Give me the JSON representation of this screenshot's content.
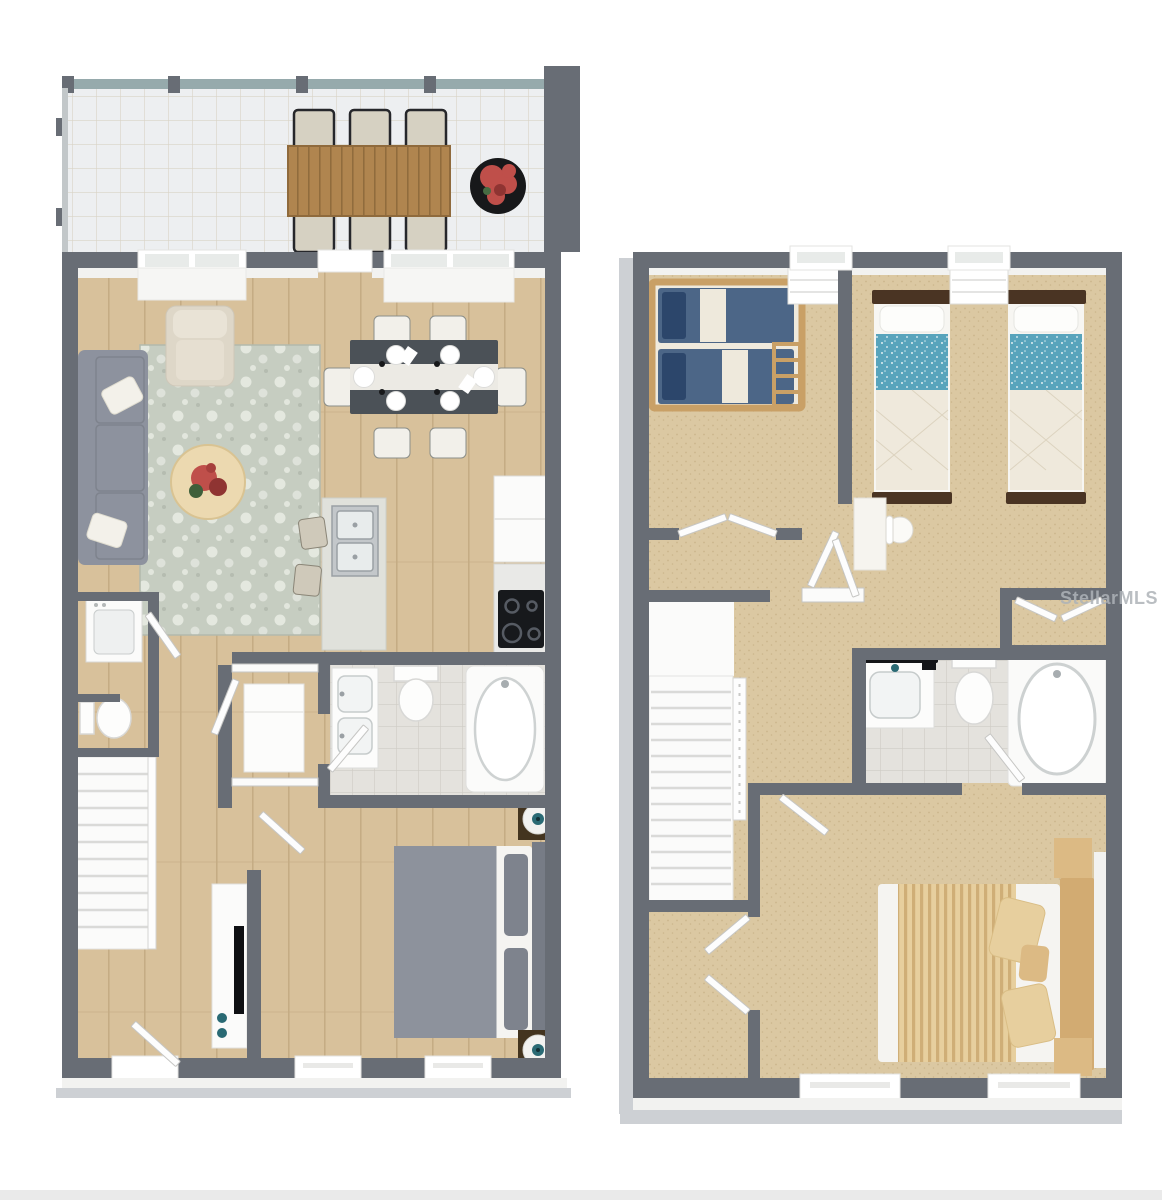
{
  "page": {
    "background": "#ffffff",
    "type": "3d-floor-plan-render",
    "bottom_bar": {
      "color": "#eaeaea",
      "border": "#d6d6d6"
    }
  },
  "watermark": {
    "text": "StellarMLS",
    "color": "#aeb3b8",
    "opacity": 0.85,
    "font_size": 18
  },
  "palette": {
    "wall": "#686d75",
    "wallFace": "#f2f2f0",
    "base3d": "#cdd0d4",
    "wood": "#d8c19b",
    "woodLine": "#c4ab83",
    "tile": "#edeff1",
    "tileLine": "#d9d3c6",
    "carpet": "#dbc8a2",
    "carpetDot": "#cbb68c",
    "bathTile": "#e4e2dd",
    "bathTileLine": "#cfccc5",
    "screen": "#96aaac",
    "rugBase": "#c6cdc1",
    "rugMotif": "#e9ece4",
    "sofa": "#8d929e",
    "sofaDark": "#7e838d",
    "pillow": "#f3f1ea",
    "armchair": "#ded7c8",
    "patioTableWood": "#b0854f",
    "patioTableLine": "#8f6a3c",
    "patioChair": "#d6d1c2",
    "chairFrame": "#26272b",
    "planter": "#17181a",
    "plant": "#bf4f4a",
    "plantDark": "#8f3432",
    "diningTable": "#4b5157",
    "runner": "#eceae4",
    "chairCream": "#f2f0ea",
    "island": "#e0e1db",
    "steel": "#c3c7ca",
    "steelDark": "#9aa0a4",
    "appliance": "#fbfbfa",
    "counter": "#e9e9e7",
    "cooktop": "#17191c",
    "burner": "#565b63",
    "stool": "#cfc9ba",
    "bedGray": "#8d929c",
    "bedPillow": "#7e838d",
    "headboard": "#777c86",
    "mattress": "#f5f4f1",
    "nightstand": "#43341f",
    "lampBase": "#f2f2f0",
    "lampTeal": "#2a6a74",
    "tv": "#0f1013",
    "bunkWood": "#c9a066",
    "bunkBlue": "#4c6687",
    "bunkNavy": "#2c466b",
    "bunkCream": "#efeadd",
    "twinFrame": "#4a3423",
    "twinTeal": "#58a4bc",
    "quilt": "#efe9dc",
    "quiltLine": "#dcd3bf",
    "desk": "#f6f4ef",
    "tan": "#dcba84",
    "tanLight": "#e7cf9e",
    "tanStripe": "#cfae77",
    "tanDark": "#d2ab72",
    "doorLeaf": "#fdfdfd",
    "doorEdge": "#c6c6c4",
    "watermark": "#aeb3b8",
    "bottomBar": "#eaeaea"
  },
  "floor_plans": [
    {
      "name": "first-floor",
      "position": "left",
      "rooms": [
        {
          "name": "screened-patio",
          "flooring": "tile-pavers",
          "furniture": [
            "outdoor-dining-table",
            "patio-chair",
            "patio-chair",
            "patio-chair",
            "patio-chair",
            "patio-chair",
            "patio-chair",
            "potted-plant"
          ]
        },
        {
          "name": "living-room",
          "flooring": "wood",
          "furniture": [
            "sofa",
            "throw-pillow",
            "throw-pillow",
            "armchair",
            "area-rug",
            "round-coffee-table",
            "flower-centerpiece"
          ]
        },
        {
          "name": "dining-area",
          "flooring": "wood",
          "furniture": [
            "dining-table",
            "table-runner",
            "place-setting-x6",
            "dining-chair-x6"
          ]
        },
        {
          "name": "kitchen",
          "flooring": "wood",
          "furniture": [
            "island-with-double-sink",
            "bar-stool",
            "bar-stool",
            "refrigerator",
            "counter",
            "cooktop"
          ]
        },
        {
          "name": "laundry-closet",
          "furniture": [
            "washer"
          ]
        },
        {
          "name": "powder-room",
          "furniture": [
            "toilet"
          ]
        },
        {
          "name": "storage-closet",
          "furniture": [
            "water-heater"
          ]
        },
        {
          "name": "staircase",
          "furniture": []
        },
        {
          "name": "bathroom",
          "flooring": "tile",
          "furniture": [
            "double-sink-vanity",
            "toilet",
            "bathtub"
          ]
        },
        {
          "name": "bedroom",
          "flooring": "wood",
          "furniture": [
            "bed",
            "headboard",
            "nightstand",
            "nightstand",
            "lamp",
            "lamp",
            "tv-console",
            "tv"
          ]
        }
      ]
    },
    {
      "name": "second-floor",
      "position": "right",
      "rooms": [
        {
          "name": "bunk-bedroom",
          "flooring": "carpet",
          "furniture": [
            "bunk-bed",
            "closet-double-doors",
            "linen-cubby"
          ]
        },
        {
          "name": "twin-bedroom",
          "flooring": "carpet",
          "furniture": [
            "twin-bed",
            "twin-bed",
            "desk",
            "desk-chair",
            "closet-double-doors",
            "linen-cubby"
          ]
        },
        {
          "name": "hallway",
          "furniture": []
        },
        {
          "name": "bathroom",
          "flooring": "tile",
          "furniture": [
            "vanity-dark-counter",
            "toilet",
            "bathtub"
          ]
        },
        {
          "name": "staircase",
          "furniture": []
        },
        {
          "name": "primary-bedroom",
          "flooring": "carpet",
          "furniture": [
            "bed",
            "striped-duvet",
            "pillow",
            "pillow",
            "pillow",
            "headboard",
            "nightstand-bench",
            "nightstand-bench"
          ]
        },
        {
          "name": "walk-in-closet",
          "flooring": "carpet",
          "furniture": [
            "double-doors"
          ]
        }
      ]
    }
  ]
}
